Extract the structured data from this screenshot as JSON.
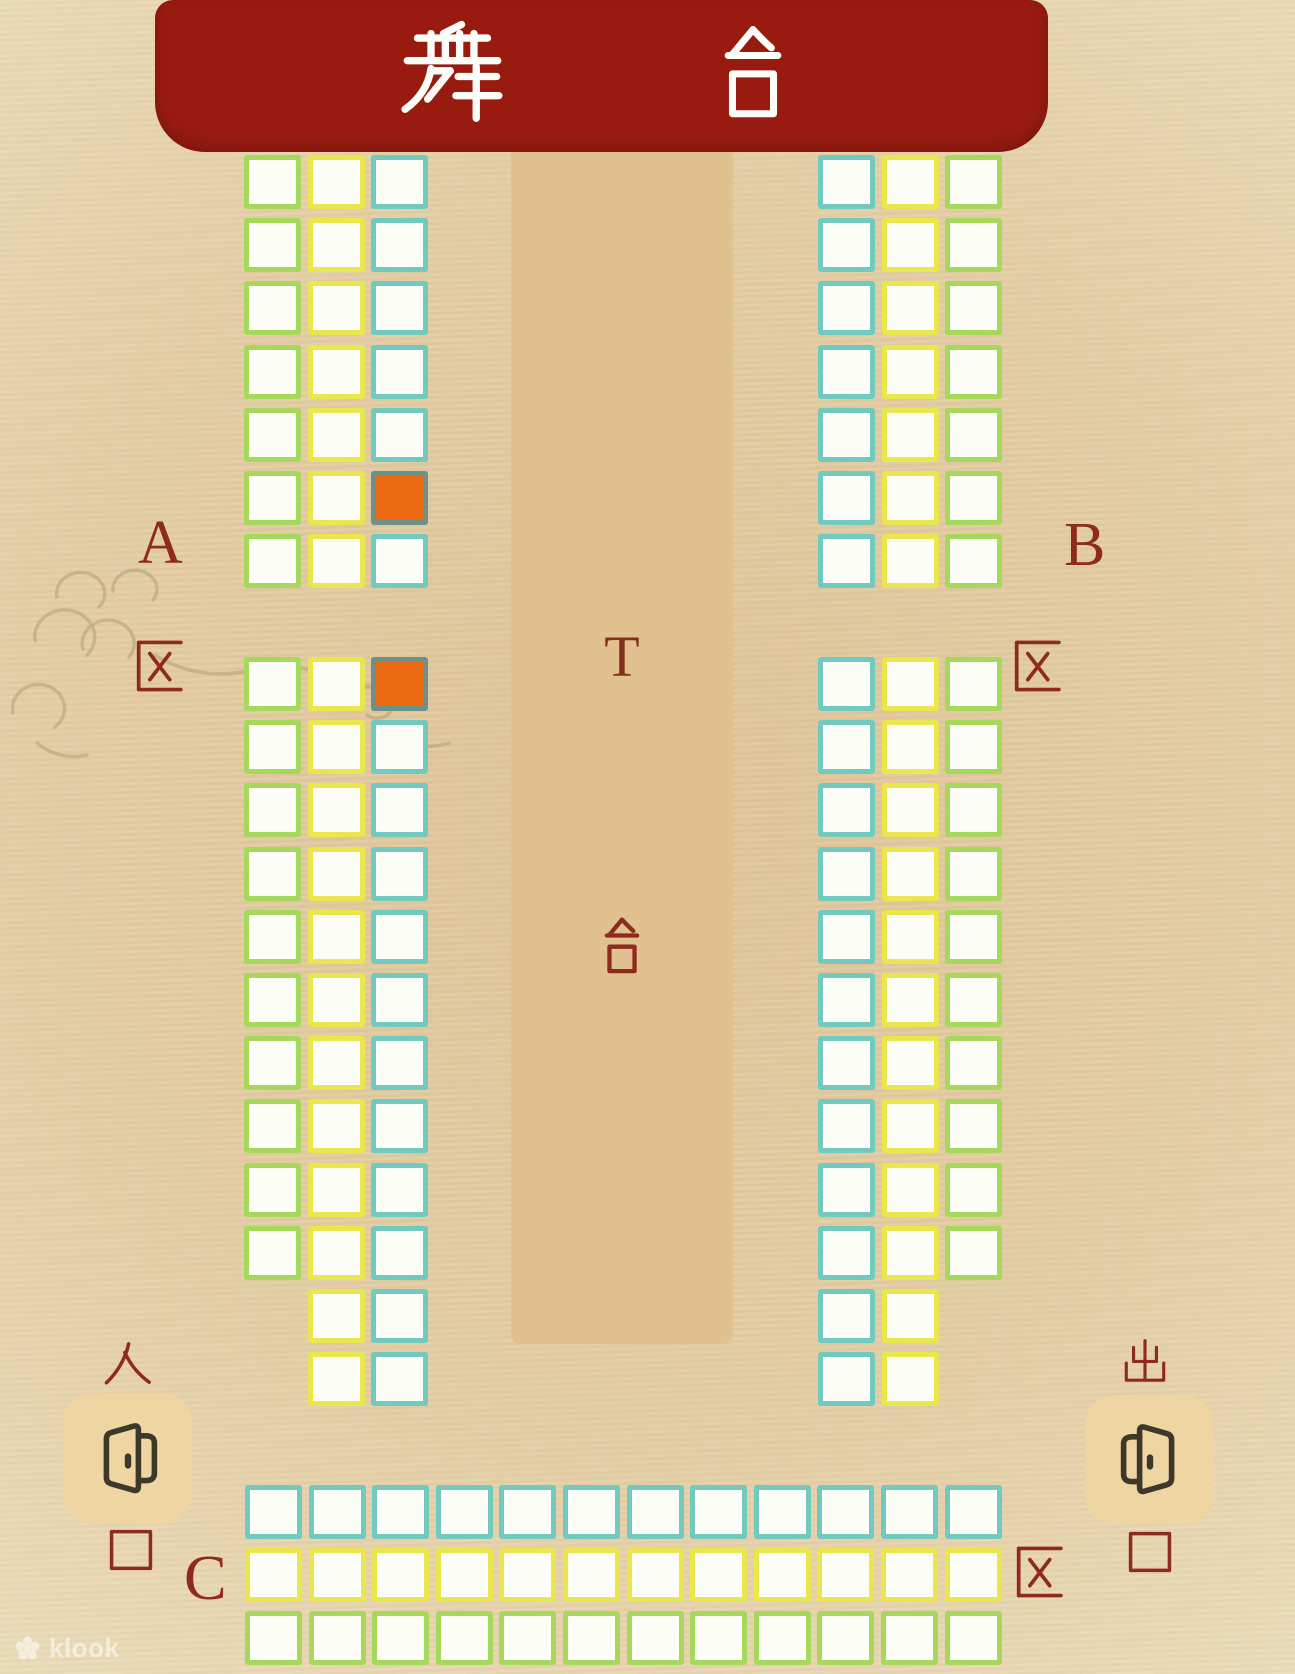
{
  "stage": {
    "label": "舞台",
    "char1": "舞",
    "char2": "台"
  },
  "runway": {
    "label_top": "T",
    "label_bottom": "台"
  },
  "zones": {
    "a": {
      "letter": "A",
      "qu": "区"
    },
    "b": {
      "letter": "B",
      "qu": "区"
    },
    "c": {
      "letter": "C",
      "qu": "区"
    }
  },
  "entrance": {
    "top": "入",
    "bottom": "口",
    "label": "入口"
  },
  "exit": {
    "top": "出",
    "bottom": "口",
    "label": "出口"
  },
  "watermark": {
    "brand": "klook"
  },
  "theme": {
    "background": "#ecdfbe",
    "stage_red": "#991b10",
    "stage_text": "#fdfdfa",
    "label_red": "#8e2b1e",
    "runway_tan": "#e1c190",
    "door_tile": "#eed5a2",
    "door_icon": "#3c392b"
  },
  "seat_map": {
    "seat_size": [
      57,
      54
    ],
    "pitch": [
      63.6,
      63.2
    ],
    "colors": {
      "green": "#a6d85c",
      "yellow": "#ebe54e",
      "cyan": "#72c9c0",
      "seat_fill": "#fcfdf6",
      "occupied_fill": "#ec6a13",
      "occupied_border": "#6b9188"
    },
    "blocks": [
      {
        "id": "zone-a-upper",
        "x": 244,
        "y": 155,
        "direction": "vertical",
        "columns": [
          {
            "color": "green",
            "rows": 7
          },
          {
            "color": "yellow",
            "rows": 7
          },
          {
            "color": "cyan",
            "rows": 7
          }
        ],
        "occupied": [
          {
            "col": 2,
            "row": 5
          }
        ]
      },
      {
        "id": "zone-a-lower",
        "x": 244,
        "y": 657,
        "direction": "vertical",
        "columns": [
          {
            "color": "green",
            "rows": 10
          },
          {
            "color": "yellow",
            "rows": 12
          },
          {
            "color": "cyan",
            "rows": 12
          }
        ],
        "occupied": [
          {
            "col": 2,
            "row": 0
          }
        ]
      },
      {
        "id": "zone-b-upper",
        "x": 818,
        "y": 155,
        "direction": "vertical",
        "columns": [
          {
            "color": "cyan",
            "rows": 7
          },
          {
            "color": "yellow",
            "rows": 7
          },
          {
            "color": "green",
            "rows": 7
          }
        ],
        "occupied": []
      },
      {
        "id": "zone-b-lower",
        "x": 818,
        "y": 657,
        "direction": "vertical",
        "columns": [
          {
            "color": "cyan",
            "rows": 12
          },
          {
            "color": "yellow",
            "rows": 12
          },
          {
            "color": "green",
            "rows": 10
          }
        ],
        "occupied": []
      },
      {
        "id": "zone-c",
        "x": 245,
        "y": 1485,
        "direction": "horizontal",
        "rows": [
          {
            "color": "cyan",
            "cols": 12
          },
          {
            "color": "yellow",
            "cols": 12
          },
          {
            "color": "green",
            "cols": 12
          }
        ],
        "occupied": []
      }
    ]
  }
}
